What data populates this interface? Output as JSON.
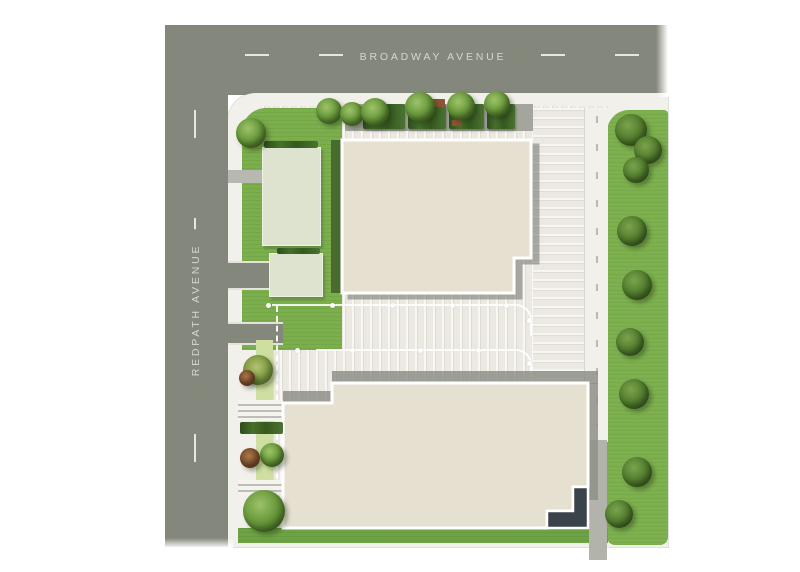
{
  "streets": {
    "broadway": {
      "label": "BROADWAY AVENUE",
      "orientation": "horizontal"
    },
    "redpath": {
      "label": "REDPATH AVENUE",
      "orientation": "vertical"
    }
  },
  "colors": {
    "road": "#84877b",
    "road_marking": "#e7e7e0",
    "road_label": "#d6d6cf",
    "sidewalk": "#f1f0ea",
    "pavement": "#ebe9e2",
    "grass": "#7aaf4b",
    "grass_side": "#7db14e",
    "grass_band": "#6da344",
    "grass_pale": "#cfdfa2",
    "annex": "#dde3cf",
    "hedge": "#3a5c26",
    "building": "#e6e0d1",
    "outline": "#ffffff",
    "shadow": "#8e9188",
    "charcoal": "#3a424a"
  },
  "features": {
    "trees": [
      {
        "x": 251,
        "y": 133,
        "r": 15,
        "tone": "mid"
      },
      {
        "x": 329,
        "y": 111,
        "r": 13,
        "tone": "mid"
      },
      {
        "x": 352,
        "y": 114,
        "r": 12,
        "tone": "mid"
      },
      {
        "x": 375,
        "y": 112,
        "r": 14,
        "tone": "mid"
      },
      {
        "x": 420,
        "y": 107,
        "r": 15,
        "tone": "mid"
      },
      {
        "x": 461,
        "y": 106,
        "r": 14,
        "tone": "mid"
      },
      {
        "x": 497,
        "y": 104,
        "r": 13,
        "tone": "mid"
      },
      {
        "x": 631,
        "y": 130,
        "r": 16,
        "tone": "dark"
      },
      {
        "x": 648,
        "y": 150,
        "r": 14,
        "tone": "dark"
      },
      {
        "x": 636,
        "y": 170,
        "r": 13,
        "tone": "dark"
      },
      {
        "x": 632,
        "y": 231,
        "r": 15,
        "tone": "dark"
      },
      {
        "x": 637,
        "y": 285,
        "r": 15,
        "tone": "dark"
      },
      {
        "x": 630,
        "y": 342,
        "r": 14,
        "tone": "dark"
      },
      {
        "x": 634,
        "y": 394,
        "r": 15,
        "tone": "dark"
      },
      {
        "x": 637,
        "y": 472,
        "r": 15,
        "tone": "dark"
      },
      {
        "x": 619,
        "y": 514,
        "r": 14,
        "tone": "dark"
      },
      {
        "x": 264,
        "y": 511,
        "r": 21,
        "tone": "mid"
      },
      {
        "x": 258,
        "y": 370,
        "r": 15,
        "tone": "olive"
      },
      {
        "x": 247,
        "y": 378,
        "r": 8,
        "tone": "red"
      },
      {
        "x": 272,
        "y": 455,
        "r": 12,
        "tone": "mid"
      },
      {
        "x": 250,
        "y": 458,
        "r": 10,
        "tone": "red"
      }
    ],
    "planters": [
      {
        "x": 363,
        "w": 42
      },
      {
        "x": 408,
        "w": 38
      },
      {
        "x": 449,
        "w": 35
      },
      {
        "x": 487,
        "w": 28
      }
    ],
    "hedges": [
      {
        "x": 264,
        "y": 141,
        "w": 54,
        "h": 7
      },
      {
        "x": 277,
        "y": 248,
        "w": 43,
        "h": 6
      },
      {
        "x": 240,
        "y": 422,
        "w": 43,
        "h": 12
      }
    ],
    "accents": [
      {
        "x": 431,
        "y": 99,
        "w": 14,
        "h": 8
      },
      {
        "x": 452,
        "y": 120,
        "w": 10,
        "h": 6
      }
    ],
    "lane_dots": [
      [
        268,
        305
      ],
      [
        332,
        305
      ],
      [
        392,
        305
      ],
      [
        452,
        305
      ],
      [
        506,
        305
      ],
      [
        297,
        350
      ],
      [
        352,
        350
      ],
      [
        420,
        350
      ],
      [
        478,
        350
      ],
      [
        529,
        320
      ],
      [
        529,
        363
      ]
    ]
  }
}
